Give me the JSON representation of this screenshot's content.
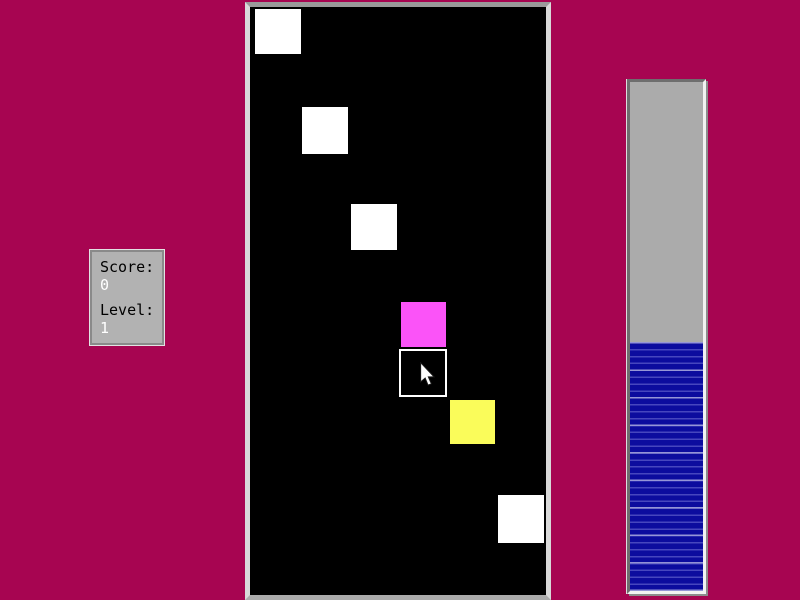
{
  "window": {
    "background_color": "#a70551"
  },
  "score_panel": {
    "score_label": "Score:",
    "score_value": "0",
    "level_label": "Level:",
    "level_value": "1",
    "panel_color": "#b2b2b2",
    "label_color": "#000000",
    "value_color": "#ffffff"
  },
  "game_board": {
    "background_color": "#000000",
    "squares": [
      {
        "name": "white-square-1",
        "style": "filled",
        "color": "#ffffff",
        "x": 5,
        "y": 2,
        "w": 46,
        "h": 45
      },
      {
        "name": "white-square-2",
        "style": "filled",
        "color": "#ffffff",
        "x": 52,
        "y": 100,
        "w": 46,
        "h": 47
      },
      {
        "name": "white-square-3",
        "style": "filled",
        "color": "#ffffff",
        "x": 101,
        "y": 197,
        "w": 46,
        "h": 46
      },
      {
        "name": "magenta-square",
        "style": "filled",
        "color": "#fb53f8",
        "x": 151,
        "y": 295,
        "w": 45,
        "h": 45
      },
      {
        "name": "outlined-square",
        "style": "outline",
        "color": "#ffffff",
        "x": 149,
        "y": 342,
        "w": 48,
        "h": 48
      },
      {
        "name": "yellow-square",
        "style": "filled",
        "color": "#fafc5a",
        "x": 200,
        "y": 393,
        "w": 45,
        "h": 44
      },
      {
        "name": "white-square-4",
        "style": "filled",
        "color": "#ffffff",
        "x": 248,
        "y": 488,
        "w": 46,
        "h": 48
      }
    ]
  },
  "progress_bar": {
    "orientation": "vertical",
    "fill_from": "bottom",
    "fill_percent": 49,
    "track_color": "#ababab",
    "fill_color": "#0c0c9e",
    "stripe_color": "#9a9ad8"
  },
  "cursor": {
    "x": 419,
    "y": 362
  }
}
